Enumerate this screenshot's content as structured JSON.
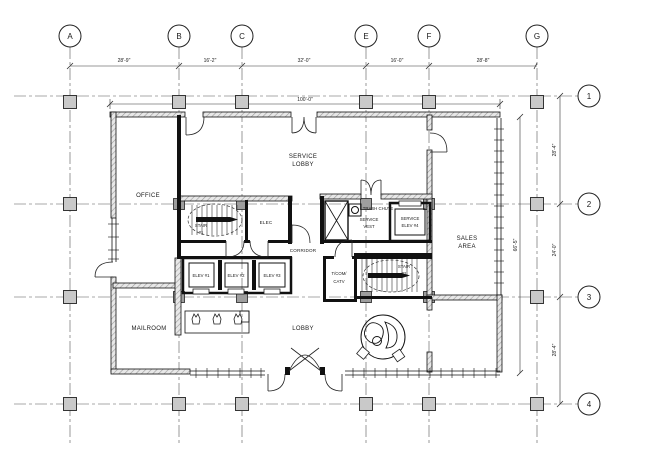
{
  "drawing": {
    "type": "architectural floor plan",
    "grid": {
      "col_labels": [
        "A",
        "B",
        "C",
        "E",
        "F",
        "G"
      ],
      "row_labels": [
        "1",
        "2",
        "3",
        "4"
      ],
      "col_dims": [
        "28'-9\"",
        "16'-2\"",
        "32'-0\"",
        "16'-0\"",
        "28'-8\""
      ],
      "row_dims": [
        "28'-4\"",
        "24'-0\"",
        "28'-4\""
      ],
      "building_width": "100'-0\"",
      "building_depth": "66'-5\""
    },
    "rooms": {
      "office": "OFFICE",
      "service_lobby": [
        "SERVICE",
        "LOBBY"
      ],
      "stair1": [
        "STAIR",
        "#1"
      ],
      "elec": "ELEC",
      "trash_chute": "TRASH CHUTE",
      "service_vest": [
        "SERVICE",
        "VEST"
      ],
      "service_elev": [
        "SERVICE",
        "ELEV #4"
      ],
      "corridor": "CORRIDOR",
      "elevators": [
        "ELEV #1",
        "ELEV #2",
        "ELEV #3"
      ],
      "telecom": [
        "T/COM/",
        "CATV"
      ],
      "stair2": [
        "STAIR",
        "#2"
      ],
      "mailroom": "MAILROOM",
      "lobby": "LOBBY",
      "sales": [
        "SALES",
        "AREA"
      ]
    },
    "colors": {
      "column_fill": "#c9c9c9",
      "wall_hatch": "#ababab",
      "line": "#1a1a1a"
    }
  }
}
